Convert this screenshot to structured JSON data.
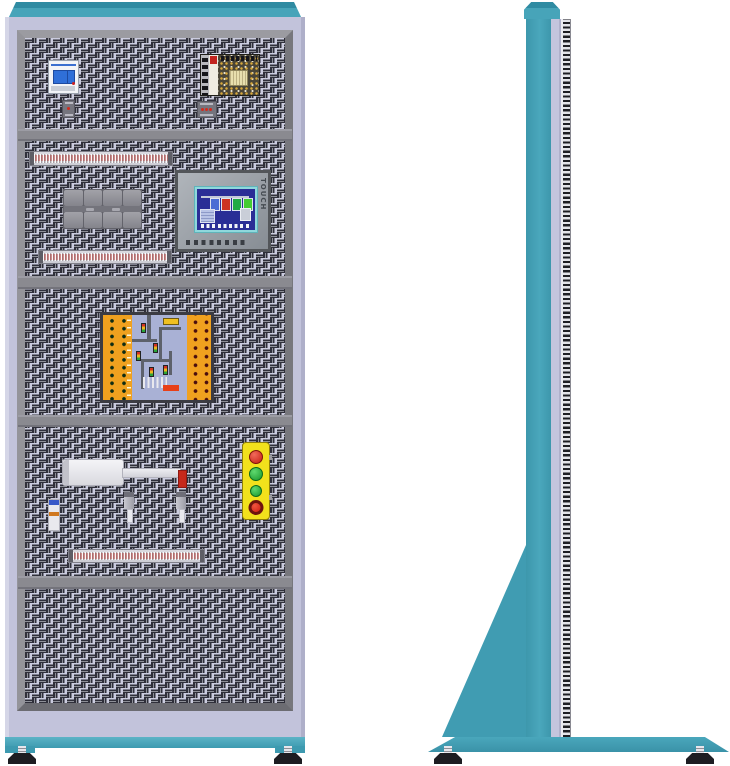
{
  "scene": {
    "type": "equipment-illustration",
    "subject": "electrical training cabinet, front view and side view",
    "views": [
      "front",
      "side"
    ]
  },
  "colors": {
    "cap_teal": "#47a4b9",
    "cap_teal_dark": "#2f8ba2",
    "body_lavender": "#c2c3db",
    "frame_gray": "#86868c",
    "panel_background": "#cbccdf",
    "panel_slot": "#2f2f3a",
    "base_teal": "#3d9ab0",
    "foot_black": "#1d1d22"
  },
  "front_view": {
    "sections": [
      {
        "name": "top-section",
        "components": [
          "circuit-breaker",
          "switching-power-supply",
          "mini-relay",
          "mini-relay-wide"
        ]
      },
      {
        "name": "second-section",
        "components": [
          "terminal-rail",
          "relay-block-cluster",
          "hmi-touch-panel",
          "terminal-rail"
        ]
      },
      {
        "name": "third-section",
        "components": [
          "plc-trainer-board"
        ]
      },
      {
        "name": "fourth-section",
        "components": [
          "pneumatic-cylinder",
          "solenoid-valve",
          "sensor",
          "sensor",
          "push-button-station",
          "terminal-rail"
        ]
      },
      {
        "name": "bottom-section",
        "components": []
      }
    ],
    "circuit_breaker": {
      "body_color": "#f2f4f7",
      "toggle_color": "#2f6fd8",
      "poles": 2
    },
    "power_supply": {
      "case_color": "#34332b",
      "label_color": "#c22420",
      "terminal_count": 5
    },
    "terminal_rails": {
      "count": 3,
      "stripe_color": "#d08c8c"
    },
    "relay_cluster": {
      "rows": 2,
      "modules_per_row": 4,
      "color": "#8e8e94"
    },
    "plc_trainer_board": {
      "left_panel_color": "#f0a11f",
      "right_panel_color": "#f0a11f",
      "board_color": "#a9b1d5",
      "terminal_dot_columns": 2,
      "theme": "traffic-light-intersection",
      "traffic_light_colors": [
        "#d43323",
        "#e9b61f",
        "#2aa43a"
      ],
      "tag_color": "#e84018"
    },
    "pneumatic_cylinder": {
      "body_color": "#e9e9ee",
      "rod_tip_color": "#c6281a"
    },
    "push_button_station": {
      "body_color": "#f2e11c",
      "buttons": [
        {
          "name": "red-push-button",
          "color": "#c41e12"
        },
        {
          "name": "green-push-button",
          "color": "#18962c"
        },
        {
          "name": "green-push-button-small",
          "color": "#18962c"
        },
        {
          "name": "emergency-stop-button",
          "color": "#cc1f10",
          "ring_color": "#6e130d"
        }
      ]
    }
  },
  "hmi": {
    "touch_label": "TOUCH",
    "bezel_color": "#9aa0a6",
    "screen_border_color": "#8fd8dc",
    "screen_color": "#2a2e96",
    "tank_colors": [
      "#4a6cd4",
      "#cc3322",
      "#22aa44",
      "#44cc33"
    ],
    "function_key_count": 8
  },
  "side_view": {
    "column_color": "#47a4b9",
    "rear_strip_color": "#c4c5dd",
    "perforated_edge": "striped",
    "gusset_color": "#409cb2",
    "base_color": "#4aa7bc",
    "feet_count": 2
  }
}
